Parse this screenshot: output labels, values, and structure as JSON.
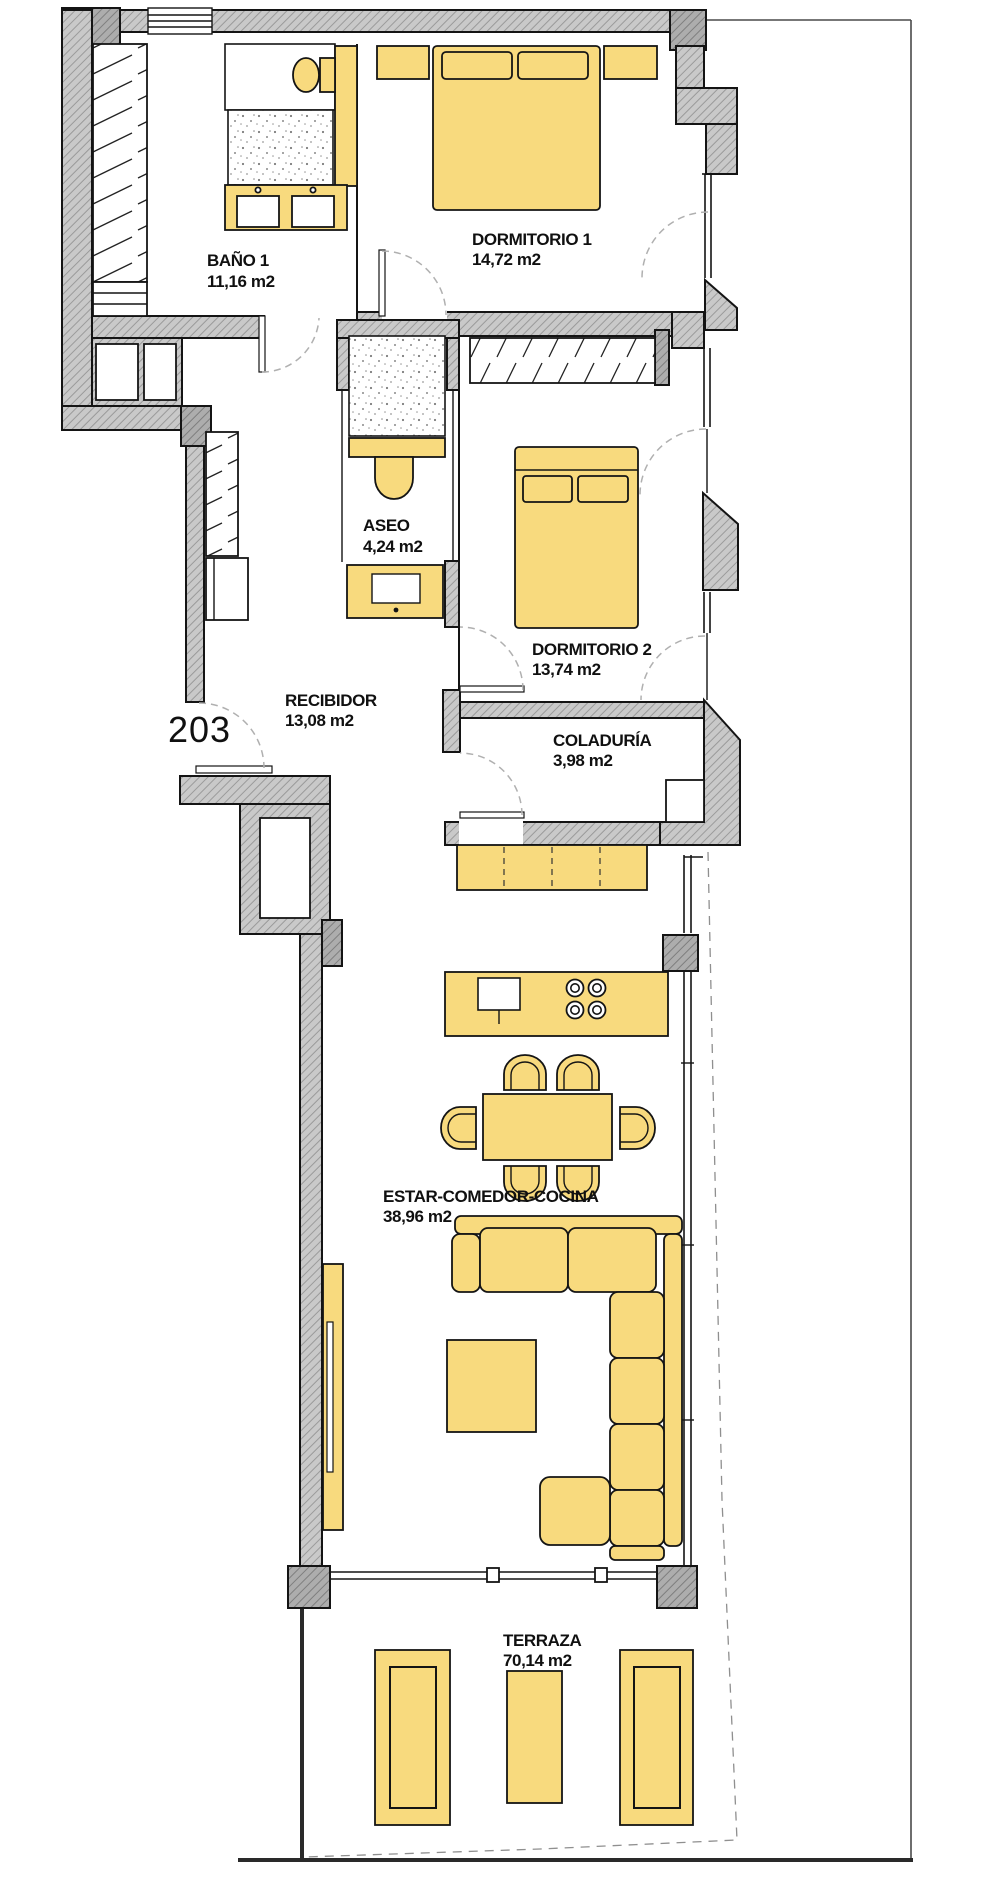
{
  "unit_number": "203",
  "colors": {
    "furniture": "#F8DA7E",
    "wall_fill": "#C9C9C9",
    "wall_hatch": "#9A9A9A",
    "wall_dark_fill": "#ADADAD",
    "wall_dark_hatch": "#7E7E7E",
    "line": "#141414",
    "door_dash": "#B0B0B0",
    "boundary_dash": "#8F8F8F"
  },
  "rooms": [
    {
      "id": "bano1",
      "name": "BAÑO 1",
      "area": "11,16 m2"
    },
    {
      "id": "dorm1",
      "name": "DORMITORIO 1",
      "area": "14,72 m2"
    },
    {
      "id": "aseo",
      "name": "ASEO",
      "area": "4,24 m2"
    },
    {
      "id": "dorm2",
      "name": "DORMITORIO 2",
      "area": "13,74 m2"
    },
    {
      "id": "recibidor",
      "name": "RECIBIDOR",
      "area": "13,08 m2"
    },
    {
      "id": "coladuria",
      "name": "COLADURÍA",
      "area": "3,98 m2"
    },
    {
      "id": "estar",
      "name": "ESTAR-COMEDOR-COCINA",
      "area": "38,96 m2"
    },
    {
      "id": "terraza",
      "name": "TERRAZA",
      "area": "70,14 m2"
    }
  ],
  "fixtures": [
    "shower-icon",
    "toilet-icon",
    "double-sink-icon",
    "wardrobe-icon",
    "double-bed-icon",
    "washbasin-icon",
    "kitchen-island-icon",
    "cooktop-icon",
    "sink-icon",
    "dining-table-icon",
    "chair-icon",
    "corner-sofa-icon",
    "coffee-table-icon",
    "tv-unit-icon",
    "sun-lounger-icon"
  ]
}
